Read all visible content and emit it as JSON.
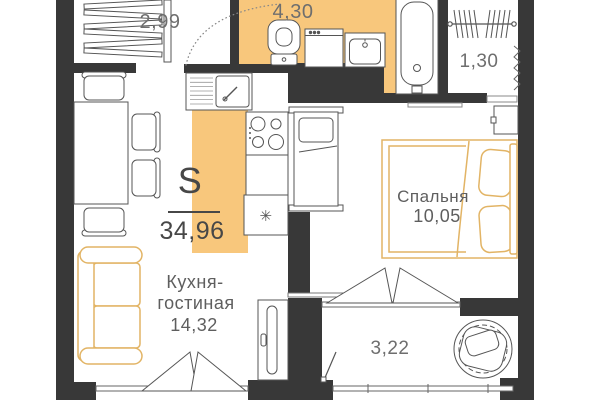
{
  "floorplan": {
    "total": {
      "symbol": "S",
      "value": "34,96"
    },
    "rooms": {
      "hallway": {
        "area": "2,99"
      },
      "bathroom": {
        "area": "4,30"
      },
      "closet": {
        "area": "1,30"
      },
      "bedroom": {
        "name": "Спальня",
        "area": "10,05"
      },
      "kitchen_living": {
        "name_line1": "Кухня-",
        "name_line2": "гостиная",
        "area": "14,32"
      },
      "balcony": {
        "area": "3,22"
      }
    },
    "icons": {
      "fridge": "✳"
    },
    "colors": {
      "wall": "#383838",
      "floor_accent": "#f8c77c",
      "furniture_accent": "#e2b465",
      "label": "#6e6e6e",
      "label_dark": "#474747"
    }
  }
}
